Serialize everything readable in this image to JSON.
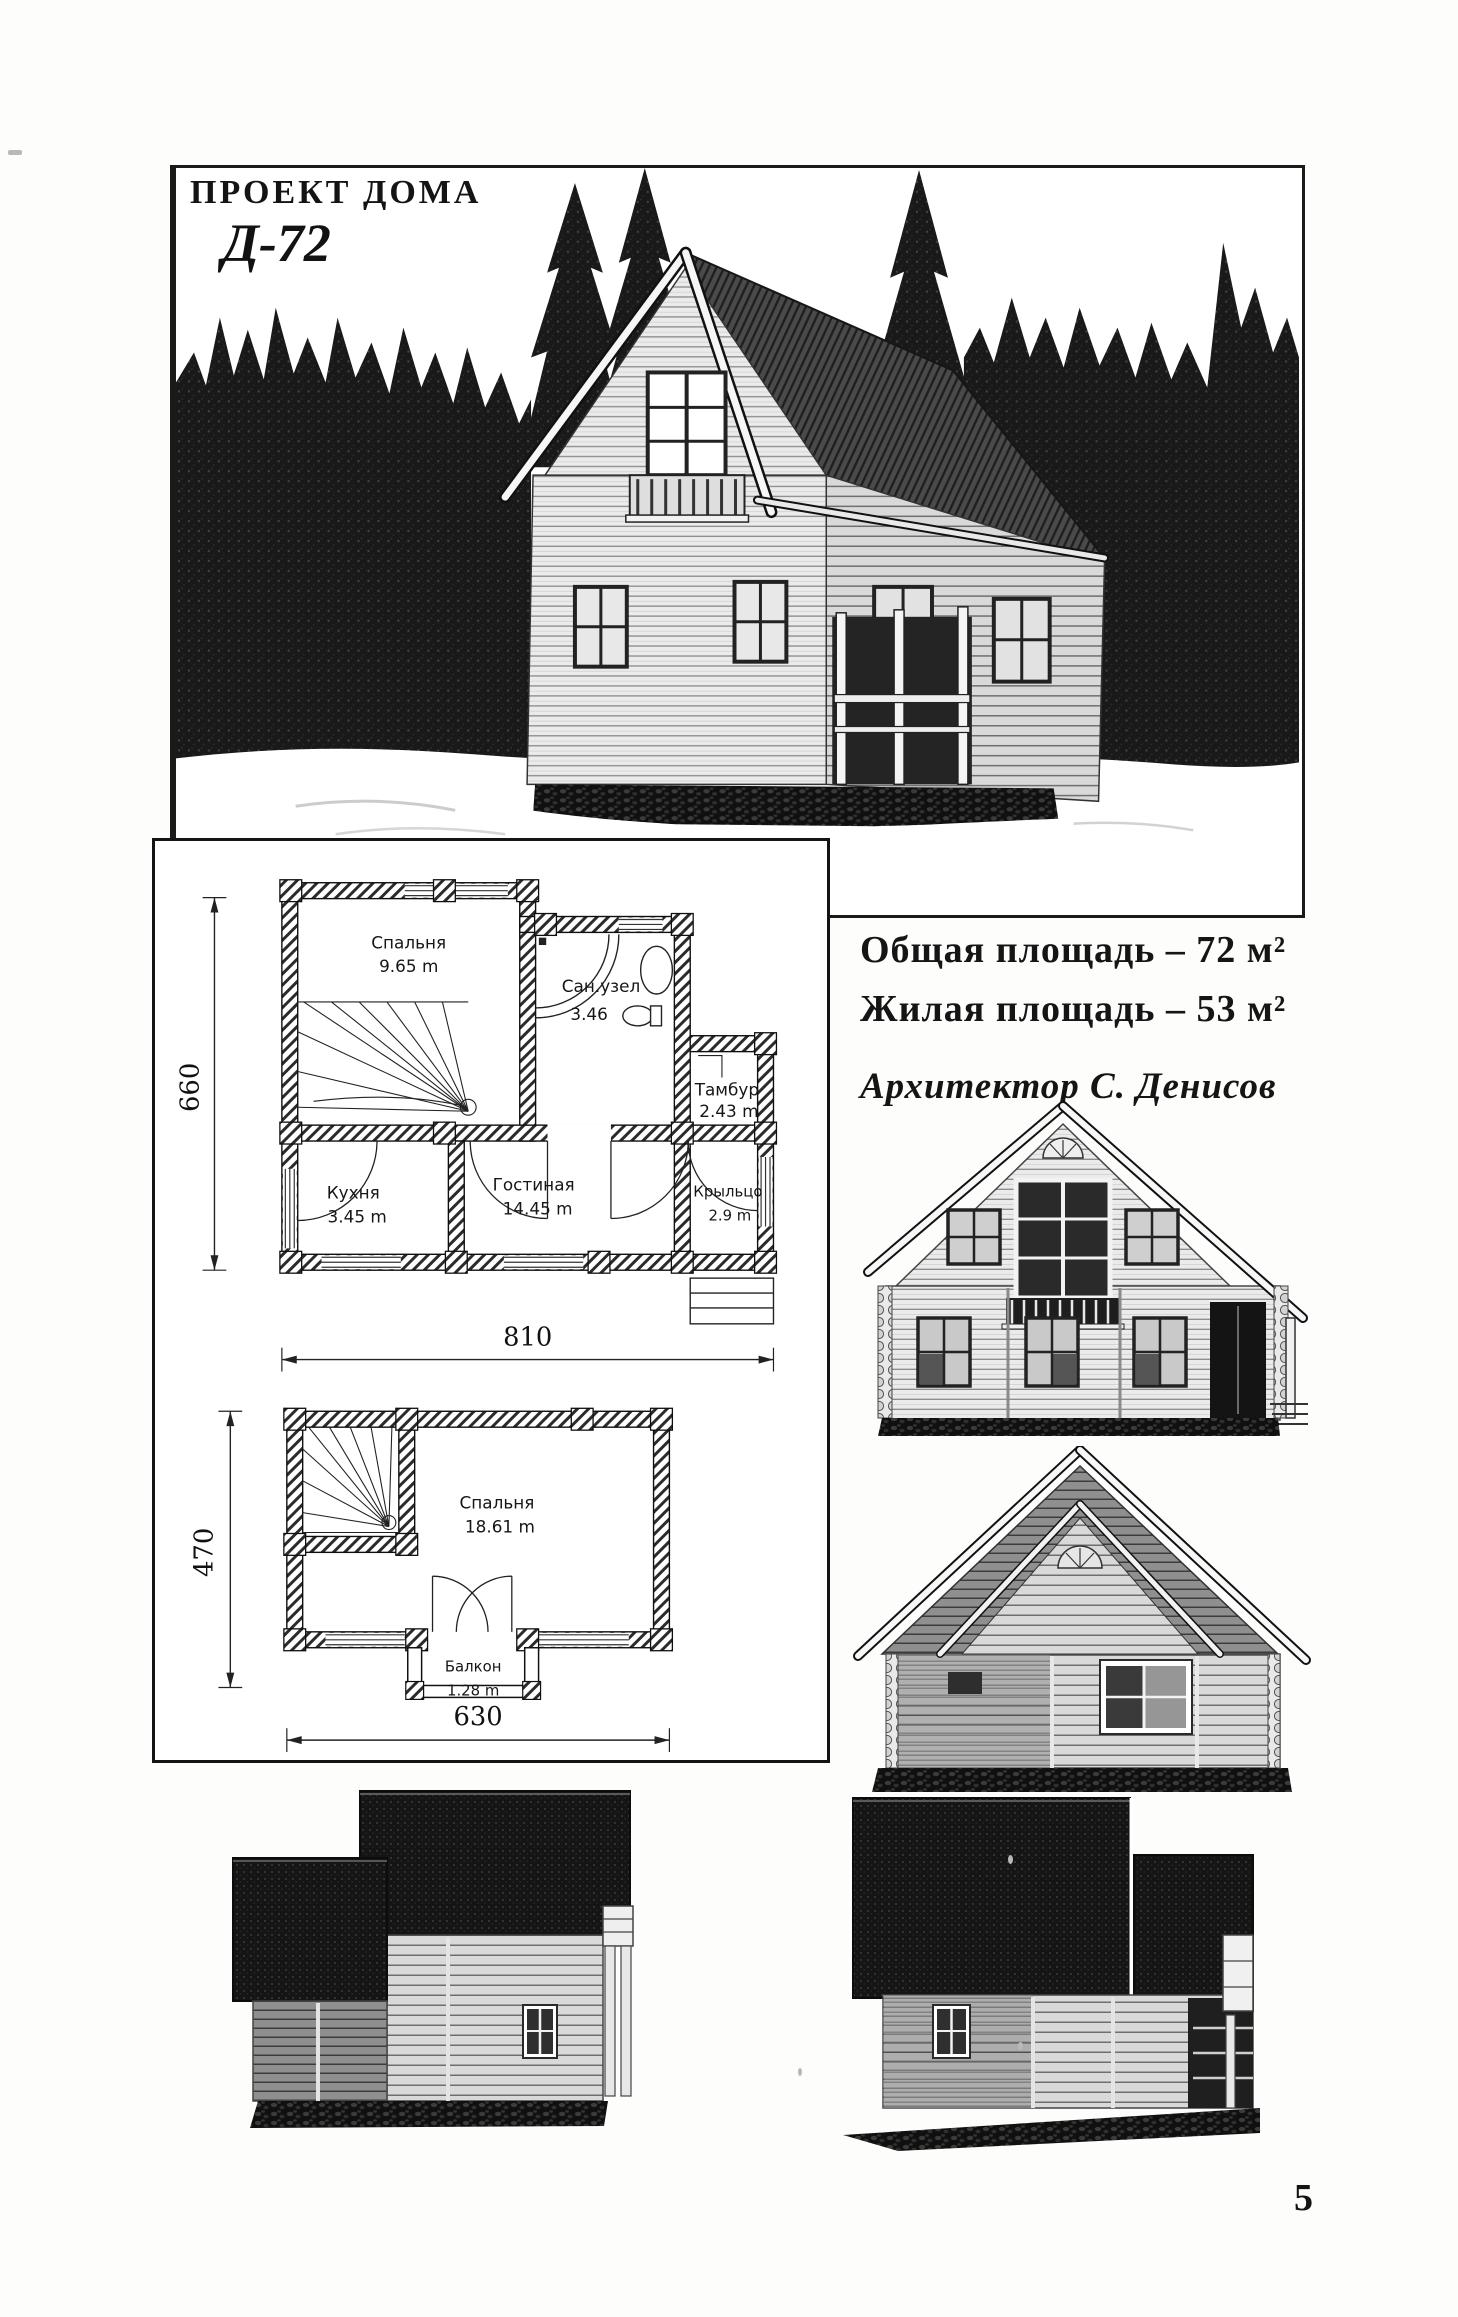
{
  "page": {
    "number": "5"
  },
  "colors": {
    "ink": "#1a1a1a",
    "paper": "#fdfdfc"
  },
  "photo_card": {
    "title": "ПРОЕКТ ДОМА",
    "code": "Д-72"
  },
  "specs": {
    "line1": "Общая площадь – 72 м²",
    "line2": "Жилая площадь – 53 м²",
    "architect": "Архитектор С. Денисов"
  },
  "plans": {
    "first": {
      "rooms": {
        "bedroom": {
          "name": "Спальня",
          "area": "9.65 m"
        },
        "bathroom": {
          "name": "Сан.узел",
          "area": "3.46"
        },
        "vestibule": {
          "name": "Тамбур",
          "area": "2.43 m"
        },
        "kitchen": {
          "name": "Кухня",
          "area": "3.45 m"
        },
        "living": {
          "name": "Гостиная",
          "area": "14.45 m"
        },
        "porch": {
          "name": "Крыльцо",
          "area": "2.9 m"
        }
      },
      "dim_height": "660",
      "dim_width": "810"
    },
    "second": {
      "rooms": {
        "bedroom": {
          "name": "Спальня",
          "area": "18.61 m"
        },
        "balcony": {
          "name": "Балкон",
          "area": "1.28 m"
        }
      },
      "dim_height": "470",
      "dim_width": "630"
    }
  }
}
